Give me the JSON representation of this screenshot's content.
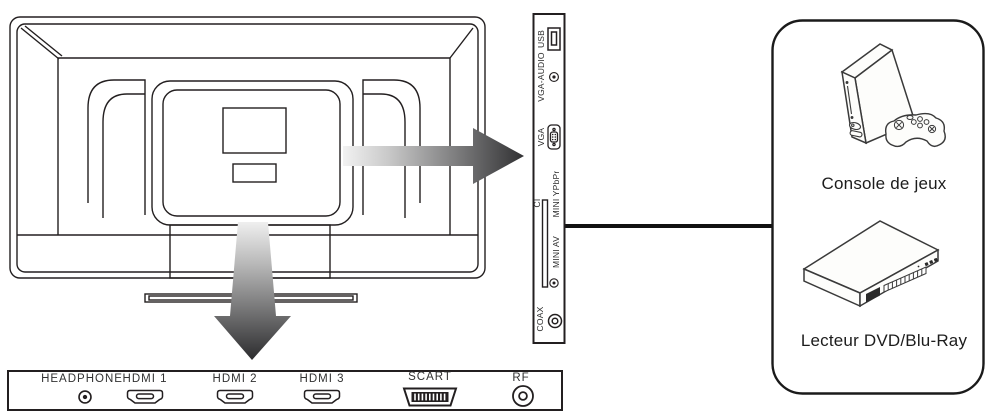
{
  "side_panel": {
    "ports": {
      "usb": "USB",
      "vga_audio": "VGA-AUDIO",
      "vga": "VGA",
      "ci": "CI",
      "mini_ypbpr": "MINI YPbPr",
      "mini_av": "MINI AV",
      "coax": "COAX"
    }
  },
  "bottom_panel": {
    "ports": {
      "headphone": "HEADPHONE",
      "hdmi1": "HDMI 1",
      "hdmi2": "HDMI 2",
      "hdmi3": "HDMI 3",
      "scart": "SCART",
      "rf": "RF"
    }
  },
  "devices": {
    "game_console": "Console de jeux",
    "dvd_player": "Lecteur DVD/Blu-Ray"
  },
  "colors": {
    "line": "#231f20",
    "arrow_dark": "#313133",
    "arrow_light": "#f2f2f2",
    "background": "#ffffff"
  }
}
